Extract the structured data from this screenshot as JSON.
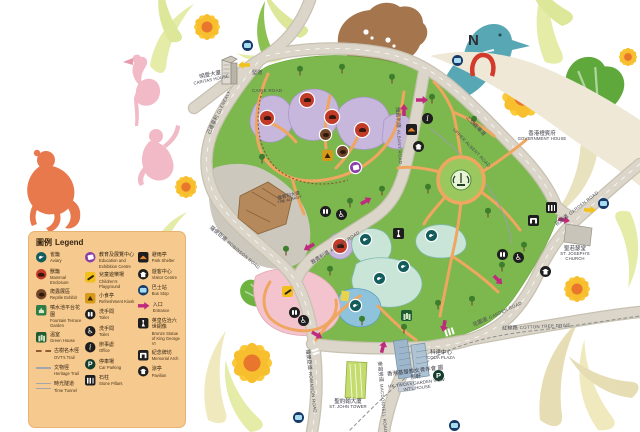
{
  "legend": {
    "title_zh": "圖例",
    "title_en": "Legend",
    "columns": [
      [
        {
          "icon": "aviary",
          "zh": "雀籠",
          "en": "Aviary"
        },
        {
          "icon": "mammal",
          "zh": "獸籠",
          "en": "Mammal Enclosure"
        },
        {
          "icon": "reptile",
          "zh": "爬蟲展區",
          "en": "Reptile Exhibit"
        },
        {
          "icon": "fountain",
          "zh": "噴水池平台花園",
          "en": "Fountain Terrace Garden"
        },
        {
          "icon": "greenhouse",
          "zh": "溫室",
          "en": "Green House"
        },
        {
          "icon": "ovt-trail",
          "zh": "古樹名木徑",
          "en": "OVT's Trail"
        },
        {
          "icon": "heritage-trail",
          "zh": "文物徑",
          "en": "Heritage Trail"
        },
        {
          "icon": "time-tunnel",
          "zh": "時光隧道",
          "en": "Time Tunnel"
        }
      ],
      [
        {
          "icon": "education",
          "zh": "教育及展覽中心",
          "en": "Education and Exhibition Centre"
        },
        {
          "icon": "playground",
          "zh": "兒童遊樂場",
          "en": "Children's Playground"
        },
        {
          "icon": "kiosk",
          "zh": "小食亭",
          "en": "Refreshment Kiosk"
        },
        {
          "icon": "toilet",
          "zh": "洗手間",
          "en": "Toilet"
        },
        {
          "icon": "toilet-accessible",
          "zh": "洗手間",
          "en": "Toilet"
        },
        {
          "icon": "office",
          "zh": "辦事處",
          "en": "Office"
        },
        {
          "icon": "parking",
          "zh": "停車場",
          "en": "Car Parking"
        },
        {
          "icon": "pillars",
          "zh": "石柱",
          "en": "Stone Pillars"
        }
      ],
      [
        {
          "icon": "shelter",
          "zh": "避雨亭",
          "en": "Park Shelter"
        },
        {
          "icon": "visitor",
          "zh": "遊客中心",
          "en": "Visitor Centre"
        },
        {
          "icon": "bus",
          "zh": "巴士站",
          "en": "Bus Stop"
        },
        {
          "icon": "entrance",
          "zh": "入口",
          "en": "Entrance"
        },
        {
          "icon": "statue",
          "zh": "英皇佐治六世銅像",
          "en": "Bronze Statue of King George VI"
        },
        {
          "icon": "arch",
          "zh": "紀念牌坊",
          "en": "Memorial Arch"
        },
        {
          "icon": "pavilion",
          "zh": "涼亭",
          "en": "Pavilion"
        }
      ]
    ]
  },
  "glyphs": {
    "north": "N",
    "parking": "P",
    "office": "i",
    "accessible": "♿"
  },
  "roads": {
    "caine": {
      "zh": "堅道",
      "en": "CAINE ROAD"
    },
    "glenealy": {
      "zh": "己連拿利",
      "en": "GLENEALY"
    },
    "robinson": {
      "zh": "羅便臣道",
      "en": "ROBINSON ROAD"
    },
    "upper_albert": {
      "zh": "上亞厘畢道",
      "en": "UPPER ALBERT ROAD"
    },
    "albany": {
      "zh": "雅賓利道",
      "en": "ALBANY ROAD"
    },
    "garden": {
      "zh": "花園道",
      "en": "GARDEN ROAD"
    },
    "cotton_tree": {
      "zh": "紅棉路",
      "en": "COTTON TREE DRIVE"
    },
    "macdonnell": {
      "zh": "麥當勞道",
      "en": "MACDONNELL ROAD"
    }
  },
  "landmarks": {
    "caritas": {
      "zh": "明愛大廈",
      "en": "CARITAS HOUSE"
    },
    "government_house": {
      "zh": "香港禮賓府",
      "en": "GOVERNMENT HOUSE"
    },
    "st_josephs": {
      "zh": "聖若瑟堂",
      "en": "ST. JOSEPH'S CHURCH"
    },
    "st_john_tower": {
      "zh": "聖約翰大廈",
      "en": "ST. JOHN TOWER"
    },
    "coda_plaza": {
      "zh": "科達中心",
      "en": "CODA PLAZA"
    },
    "garden_view": {
      "zh": "香港基督教女青年會 園景軒",
      "en": "HK YWCA's GARDEN VIEW INT'L HOUSE"
    },
    "the_albany": {
      "zh": "雅賓利大廈",
      "en": "THE ALBANY"
    }
  },
  "colors": {
    "park_green": "#7CB84E",
    "road_fill": "#DBD6C9",
    "path_orange": "#EFA660",
    "mammal_purple": "#C7B7DC",
    "pond_teal": "#C9E5D8",
    "playground_pink": "#F3C4CD",
    "legend_bg": "#F6C98F",
    "entrance_magenta": "#C02A7E",
    "arrow_yellow": "#F2C21C",
    "bird_teal": "#58A7B4",
    "monkey_orange": "#E8794C",
    "north_red": "#D43A2C"
  }
}
